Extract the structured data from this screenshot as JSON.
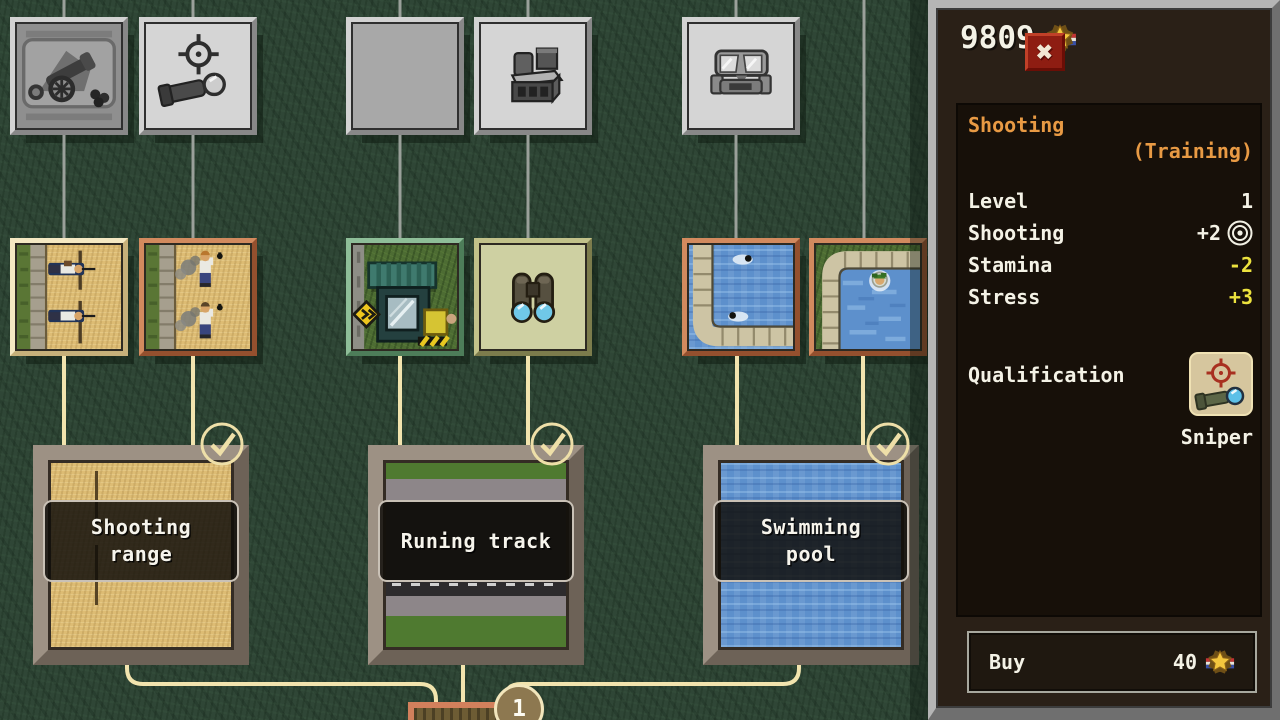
{
  "header": {
    "balance": "9809",
    "balance_icon": "medal-star",
    "close_icon": "x"
  },
  "detail_panel": {
    "title": "Shooting",
    "category": "(Training)",
    "stats": [
      {
        "label": "Level",
        "value": "1"
      },
      {
        "label": "Shooting",
        "value": "+2",
        "value_icon": "target"
      },
      {
        "label": "Stamina",
        "value": "-2"
      },
      {
        "label": "Stress",
        "value": "+3"
      }
    ],
    "qualification": {
      "label": "Qualification",
      "name": "Sniper",
      "icon": "sniper-rifle-scope"
    },
    "buy": {
      "label": "Buy",
      "price": "40",
      "price_icon": "medal-star"
    }
  },
  "tech_tree": {
    "locked_upgrades": [
      {
        "icon": "cannon"
      },
      {
        "icon": "sniper-scope"
      },
      {
        "icon": "empty"
      },
      {
        "icon": "field-equipment"
      },
      {
        "icon": "gas-mask"
      }
    ],
    "unlocked_upgrades": [
      {
        "icon": "prone-shooting-scene"
      },
      {
        "icon": "grenade-throwing-scene"
      },
      {
        "icon": "guard-post-scene"
      },
      {
        "icon": "binoculars"
      },
      {
        "icon": "pool-swimmers-scene"
      },
      {
        "icon": "pool-float-scene"
      }
    ],
    "buildings": [
      {
        "name": "Shooting\nrange",
        "completed": true
      },
      {
        "name": "Runing track",
        "completed": true
      },
      {
        "name": "Swimming\npool",
        "completed": true
      }
    ],
    "next_node_badge": "1"
  },
  "colors": {
    "accent_orange": "#e89a44",
    "stat_yellow": "#ece23e",
    "text_white": "#f4f2e6",
    "connector_cream": "#f2e4ae",
    "connector_gray": "#9aa09a",
    "panel_bg": "#2a2017",
    "panel_inner_bg": "#171009",
    "close_red": "#8e1d12"
  }
}
